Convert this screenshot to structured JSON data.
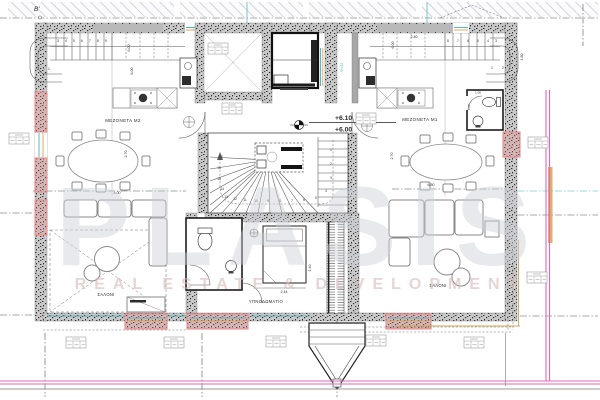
{
  "labels": {
    "section_marker": "B'",
    "level_upper": "+6.10",
    "level_lower": "+6.00",
    "unit_left": "ΜΕΖΟΝΕΤΑ Μ2",
    "unit_right": "ΜΕΖΟΝΕΤΑ Μ1",
    "living_left": "ΣΑΛΟΝΙ",
    "living_right": "ΣΑΛΟΝΙ",
    "bedroom": "ΥΠΝΟΔΩΜΑΤΙΟ",
    "elevator": "Φ=42"
  },
  "dimensions": {
    "left_table_w": "4.00",
    "left_table_d": "2.70",
    "right_table_w": "6.50",
    "right_table_d": "2.70",
    "bed_w": "2.44",
    "bed_d": "1.40",
    "kitchen_right_w": "2.40",
    "stair_left_run": "6.00",
    "stair_left_run2": "6.00",
    "stair_right_run": "6.00",
    "stair_right_curve": "1.80",
    "wc_w": "1.00",
    "wc_d": "1.00"
  },
  "stairs": {
    "central": [
      "1",
      "2",
      "3",
      "4",
      "5",
      "6",
      "7",
      "8",
      "9",
      "10",
      "11",
      "12",
      "13",
      "14",
      "15",
      "16",
      "17"
    ],
    "top_left": [
      "1",
      "2",
      "3",
      "4",
      "5",
      "6",
      "7",
      "8",
      "9"
    ],
    "top_right": [
      "8",
      "7",
      "6",
      "5",
      "4",
      "3",
      "2",
      "1"
    ]
  },
  "watermark": {
    "title": "PLASIS",
    "subtitle": "REAL ESTATE & DEVELOPMENT"
  },
  "colors": {
    "wall": "#c8c8c8",
    "speckle": "#2f2f2f",
    "pink": "#ef8a8a",
    "boundary": "#e26ab4",
    "teal": "#3ab6bf",
    "orange": "#d8a44d",
    "wm": "#ccd0d6",
    "wmsub": "#d7b9b9"
  }
}
